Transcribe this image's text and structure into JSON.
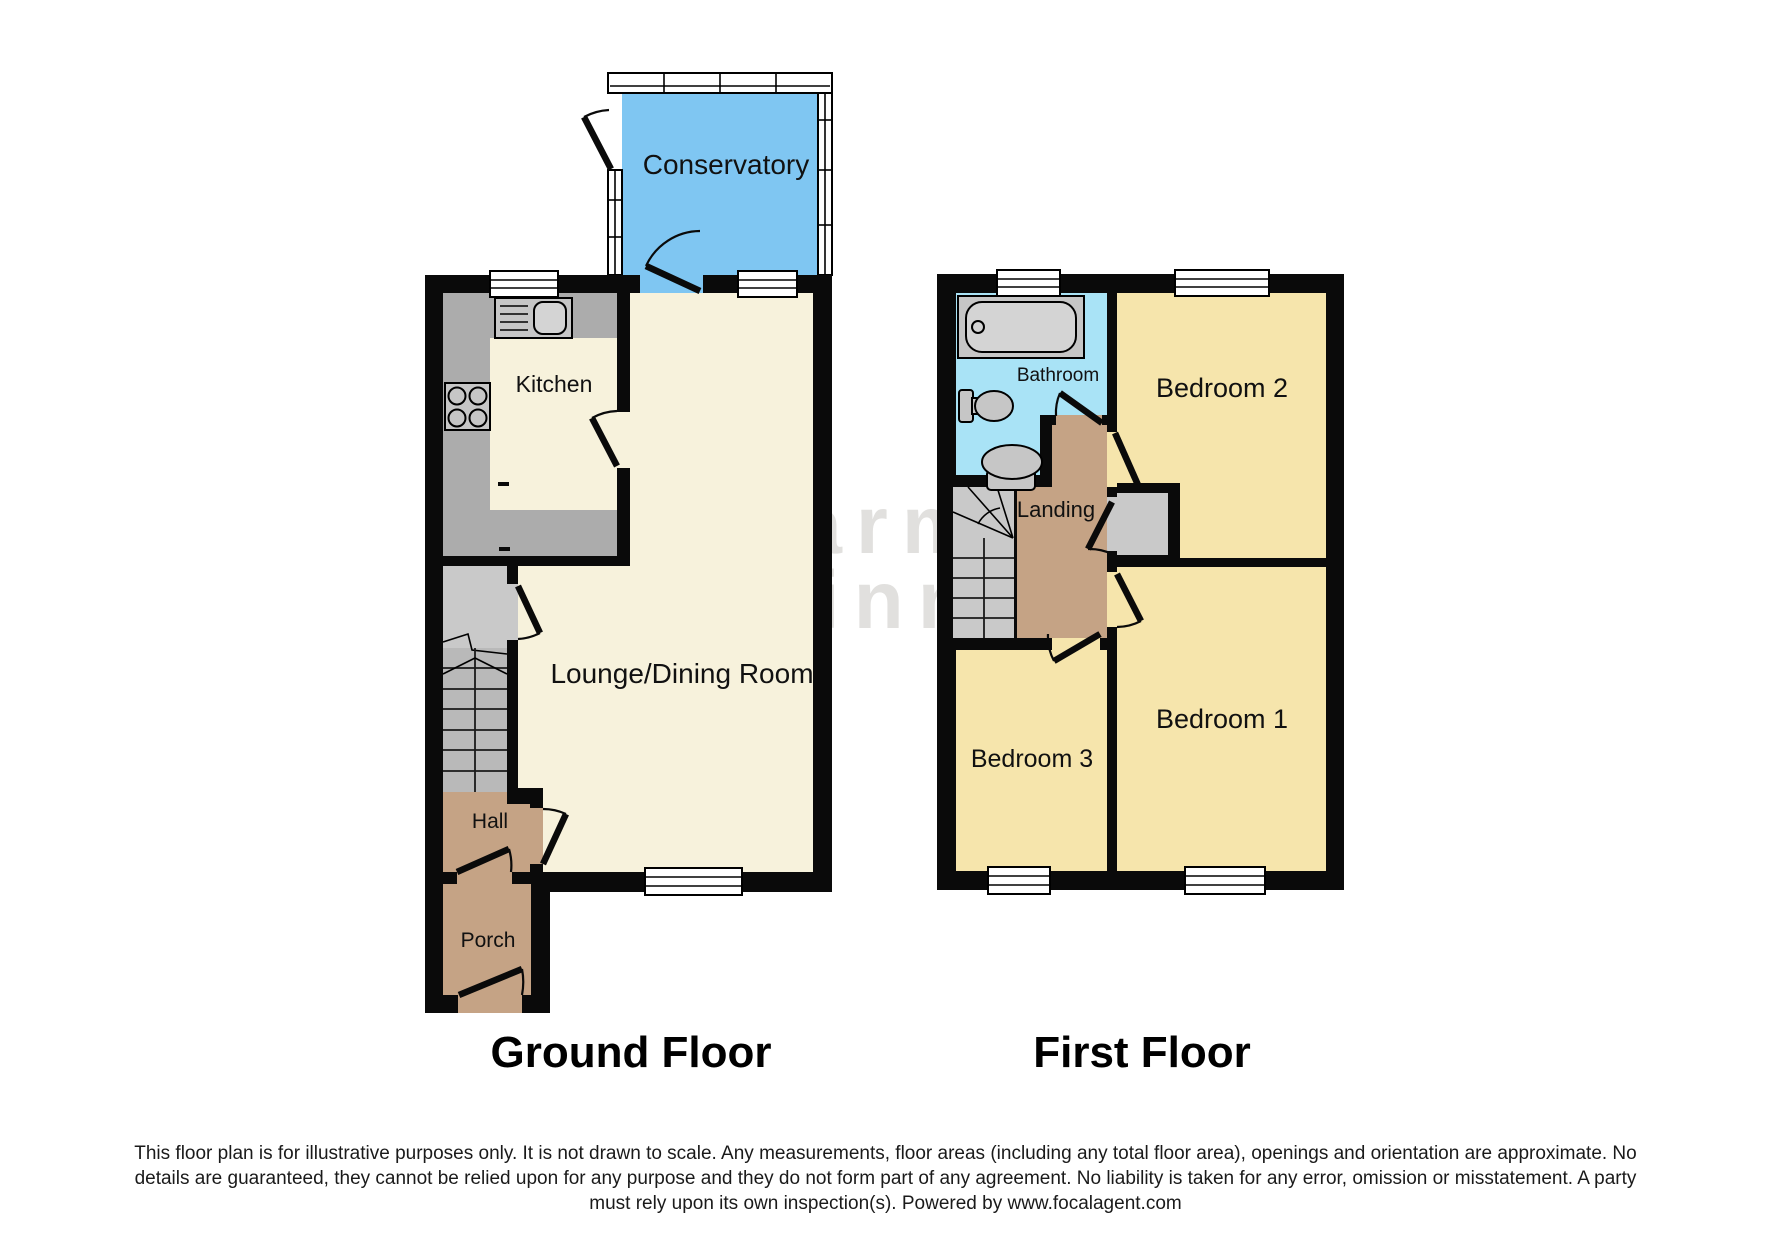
{
  "watermark": {
    "line1": "Sharman",
    "line2": "Quinney"
  },
  "ground_floor": {
    "title": "Ground Floor",
    "rooms": {
      "conservatory": "Conservatory",
      "kitchen": "Kitchen",
      "lounge": "Lounge/Dining Room",
      "hall": "Hall",
      "porch": "Porch"
    }
  },
  "first_floor": {
    "title": "First Floor",
    "rooms": {
      "bathroom": "Bathroom",
      "bedroom2": "Bedroom 2",
      "landing": "Landing",
      "bedroom1": "Bedroom 1",
      "bedroom3": "Bedroom 3"
    }
  },
  "footer": {
    "disclaimer_lines": [
      "This floor plan is for illustrative purposes only. It is not drawn to scale. Any measurements, floor areas (including any total floor area), openings and orientation are approximate. No",
      "details are guaranteed, they cannot be relied upon for any purpose and they do not form part of any agreement. No liability is taken for any error, omission or misstatement. A party",
      "must rely upon its own inspection(s). Powered by www.focalagent.com"
    ]
  },
  "colors": {
    "wall": "#0a0a0a",
    "floor_cream": "#F7F2DC",
    "bedroom_yellow": "#F6E5AC",
    "hallway_brown": "#C5A385",
    "conservatory_blue": "#7FC6F2",
    "bathroom_blue": "#A9E3F6",
    "counter_grey": "#ACACAC",
    "stairs_grey": "#C9C9C9",
    "stairs_dark": "#B9B9B9",
    "fixture_grey": "#C6C6C6",
    "fixture_light": "#D4D4D4",
    "window_white": "#FFFFFF",
    "watermark": "rgba(70,64,52,0.16)"
  }
}
